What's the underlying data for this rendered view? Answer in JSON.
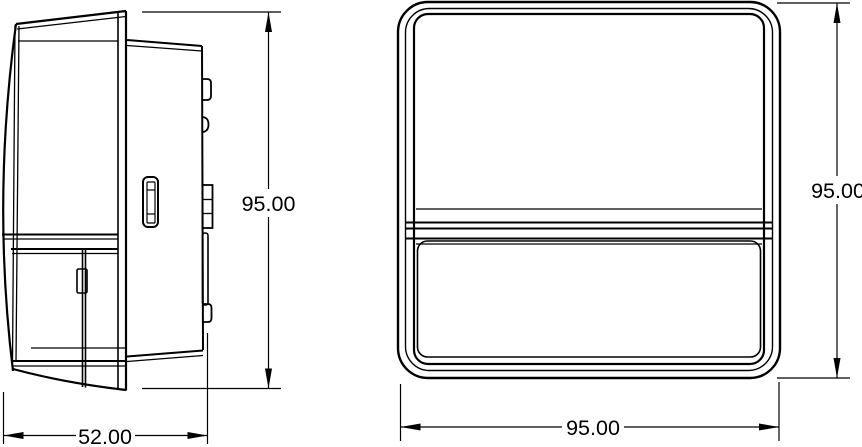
{
  "colors": {
    "line": "#000000",
    "background": "#ffffff"
  },
  "dimensions": {
    "side_depth": "52.00",
    "side_height": "95.00",
    "front_width": "95.00",
    "front_height": "95.00"
  }
}
